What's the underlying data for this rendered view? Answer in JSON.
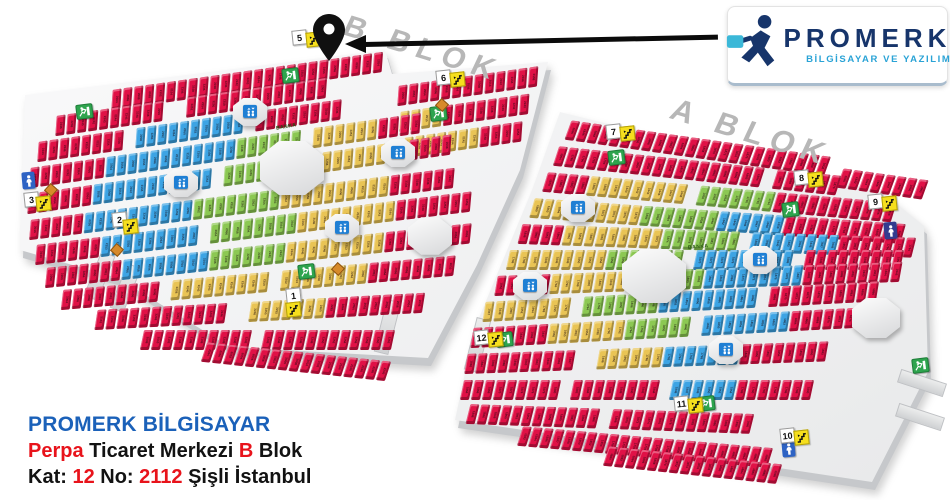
{
  "logo_card": {
    "brand": "PROMERK",
    "tagline": "BİLGİSAYAR VE YAZILIM",
    "brand_color": "#17356b",
    "tagline_color": "#2aa3d6",
    "briefcase_color": "#3bb8d8"
  },
  "address": {
    "line1": "PROMERK BİLGİSAYAR",
    "line2_parts": [
      {
        "t": "Perpa",
        "red": true
      },
      {
        "t": " Ticaret Merkezi ",
        "red": false
      },
      {
        "t": "B",
        "red": true
      },
      {
        "t": " Blok",
        "red": false
      }
    ],
    "line3_parts": [
      {
        "t": "Kat: ",
        "red": false
      },
      {
        "t": "12",
        "red": true
      },
      {
        "t": " No: ",
        "red": false
      },
      {
        "t": "2112",
        "red": true
      },
      {
        "t": " Şişli İstanbul",
        "red": false
      }
    ],
    "accent_blue": "#1b61b9",
    "accent_red": "#e8131b"
  },
  "map": {
    "colors": {
      "red": "#e01146",
      "blue": "#3da4e4",
      "green": "#8cc853",
      "yellow": "#e9c455"
    },
    "block_labels": [
      {
        "text": "B BLOK",
        "x": 352,
        "y": 10,
        "angle": 17,
        "size": 30
      },
      {
        "text": "A BLOK",
        "x": 680,
        "y": 92,
        "angle": 17,
        "size": 31
      }
    ],
    "banka_labels": [
      {
        "text": "BANKA",
        "x": 276,
        "y": 124,
        "angle": -10
      },
      {
        "text": "BANKA",
        "x": 688,
        "y": 244,
        "angle": -5
      }
    ],
    "plates": [
      {
        "id": "b",
        "points": [
          [
            25,
            95
          ],
          [
            385,
            50
          ],
          [
            392,
            74
          ],
          [
            548,
            62
          ],
          [
            520,
            170
          ],
          [
            477,
            265
          ],
          [
            428,
            358
          ],
          [
            230,
            347
          ],
          [
            118,
            278
          ],
          [
            20,
            250
          ]
        ]
      },
      {
        "id": "a",
        "points": [
          [
            560,
            112
          ],
          [
            882,
            192
          ],
          [
            924,
            226
          ],
          [
            928,
            372
          ],
          [
            872,
            482
          ],
          [
            640,
            447
          ],
          [
            455,
            420
          ],
          [
            474,
            330
          ],
          [
            532,
            190
          ]
        ]
      }
    ],
    "rows": [
      {
        "set": "b",
        "x": 112,
        "y": 90,
        "a": -8,
        "segs": [
          [
            "red",
            25
          ]
        ]
      },
      {
        "set": "b",
        "x": 398,
        "y": 86,
        "a": -8,
        "segs": [
          [
            "red",
            13
          ]
        ]
      },
      {
        "set": "b",
        "x": 56,
        "y": 116,
        "a": -8,
        "segs": [
          [
            "red",
            10
          ],
          [
            "gap",
            2
          ],
          [
            "red",
            13
          ]
        ]
      },
      {
        "set": "b",
        "x": 400,
        "y": 112,
        "a": -8,
        "segs": [
          [
            "yellow",
            4
          ],
          [
            "red",
            8
          ]
        ]
      },
      {
        "set": "b",
        "x": 38,
        "y": 142,
        "a": -8,
        "segs": [
          [
            "red",
            8
          ],
          [
            "gap",
            1
          ],
          [
            "blue",
            10
          ],
          [
            "gap",
            1
          ],
          [
            "red",
            8
          ]
        ]
      },
      {
        "set": "b",
        "x": 404,
        "y": 138,
        "a": -8,
        "segs": [
          [
            "yellow",
            7
          ],
          [
            "red",
            4
          ]
        ]
      },
      {
        "set": "b",
        "x": 30,
        "y": 168,
        "a": -8,
        "segs": [
          [
            "red",
            7
          ],
          [
            "blue",
            12
          ],
          [
            "green",
            6
          ],
          [
            "gap",
            1
          ],
          [
            "yellow",
            6
          ],
          [
            "red",
            4
          ]
        ]
      },
      {
        "set": "b",
        "x": 28,
        "y": 194,
        "a": -8,
        "segs": [
          [
            "red",
            6
          ],
          [
            "blue",
            11
          ],
          [
            "gap",
            1
          ],
          [
            "green",
            7
          ],
          [
            "yellow",
            9
          ],
          [
            "red",
            5
          ]
        ]
      },
      {
        "set": "b",
        "x": 30,
        "y": 220,
        "a": -7,
        "segs": [
          [
            "red",
            5
          ],
          [
            "blue",
            10
          ],
          [
            "green",
            8
          ],
          [
            "yellow",
            10
          ],
          [
            "red",
            6
          ]
        ]
      },
      {
        "set": "b",
        "x": 36,
        "y": 245,
        "a": -7,
        "segs": [
          [
            "red",
            6
          ],
          [
            "blue",
            9
          ],
          [
            "gap",
            1
          ],
          [
            "green",
            8
          ],
          [
            "yellow",
            9
          ],
          [
            "red",
            7
          ]
        ]
      },
      {
        "set": "b",
        "x": 46,
        "y": 268,
        "a": -6,
        "segs": [
          [
            "red",
            7
          ],
          [
            "blue",
            8
          ],
          [
            "green",
            7
          ],
          [
            "yellow",
            9
          ],
          [
            "red",
            8
          ]
        ]
      },
      {
        "set": "b",
        "x": 62,
        "y": 290,
        "a": -5,
        "segs": [
          [
            "red",
            9
          ],
          [
            "gap",
            1
          ],
          [
            "yellow",
            9
          ],
          [
            "gap",
            1
          ],
          [
            "yellow",
            8
          ],
          [
            "red",
            8
          ]
        ]
      },
      {
        "set": "b",
        "x": 96,
        "y": 310,
        "a": -3,
        "segs": [
          [
            "red",
            12
          ],
          [
            "gap",
            2
          ],
          [
            "yellow",
            7
          ],
          [
            "red",
            9
          ]
        ]
      },
      {
        "set": "b",
        "x": 142,
        "y": 330,
        "a": 0,
        "segs": [
          [
            "red",
            10
          ],
          [
            "gap",
            1
          ],
          [
            "red",
            12
          ]
        ]
      },
      {
        "set": "b",
        "x": 204,
        "y": 342,
        "a": 6,
        "segs": [
          [
            "red",
            17
          ]
        ]
      },
      {
        "set": "a",
        "x": 568,
        "y": 120,
        "a": 8,
        "segs": [
          [
            "red",
            24
          ]
        ]
      },
      {
        "set": "a",
        "x": 840,
        "y": 168,
        "a": 8,
        "segs": [
          [
            "red",
            8
          ]
        ]
      },
      {
        "set": "a",
        "x": 556,
        "y": 146,
        "a": 6,
        "segs": [
          [
            "red",
            19
          ],
          [
            "gap",
            1
          ],
          [
            "red",
            6
          ]
        ]
      },
      {
        "set": "a",
        "x": 545,
        "y": 172,
        "a": 5,
        "segs": [
          [
            "red",
            4
          ],
          [
            "yellow",
            9
          ],
          [
            "gap",
            1
          ],
          [
            "green",
            7
          ],
          [
            "red",
            11
          ]
        ]
      },
      {
        "set": "a",
        "x": 532,
        "y": 198,
        "a": 4,
        "segs": [
          [
            "yellow",
            10
          ],
          [
            "green",
            7
          ],
          [
            "blue",
            6
          ],
          [
            "red",
            11
          ]
        ]
      },
      {
        "set": "a",
        "x": 520,
        "y": 224,
        "a": 2,
        "segs": [
          [
            "red",
            4
          ],
          [
            "yellow",
            9
          ],
          [
            "green",
            7
          ],
          [
            "gap",
            1
          ],
          [
            "blue",
            8
          ],
          [
            "red",
            7
          ]
        ]
      },
      {
        "set": "a",
        "x": 508,
        "y": 250,
        "a": 0,
        "segs": [
          [
            "yellow",
            9
          ],
          [
            "green",
            7
          ],
          [
            "gap",
            1
          ],
          [
            "blue",
            9
          ],
          [
            "gap",
            1
          ],
          [
            "red",
            9
          ]
        ]
      },
      {
        "set": "a",
        "x": 496,
        "y": 276,
        "a": -2,
        "segs": [
          [
            "red",
            5
          ],
          [
            "yellow",
            8
          ],
          [
            "green",
            6
          ],
          [
            "blue",
            9
          ],
          [
            "red",
            9
          ]
        ]
      },
      {
        "set": "a",
        "x": 484,
        "y": 302,
        "a": -3,
        "segs": [
          [
            "yellow",
            8
          ],
          [
            "gap",
            1
          ],
          [
            "green",
            7
          ],
          [
            "blue",
            9
          ],
          [
            "gap",
            1
          ],
          [
            "red",
            10
          ]
        ]
      },
      {
        "set": "a",
        "x": 472,
        "y": 328,
        "a": -3,
        "segs": [
          [
            "red",
            7
          ],
          [
            "yellow",
            7
          ],
          [
            "green",
            6
          ],
          [
            "gap",
            1
          ],
          [
            "blue",
            8
          ],
          [
            "red",
            9
          ]
        ]
      },
      {
        "set": "a",
        "x": 466,
        "y": 354,
        "a": -2,
        "segs": [
          [
            "red",
            10
          ],
          [
            "gap",
            2
          ],
          [
            "yellow",
            6
          ],
          [
            "blue",
            7
          ],
          [
            "red",
            8
          ]
        ]
      },
      {
        "set": "a",
        "x": 462,
        "y": 380,
        "a": 0,
        "segs": [
          [
            "red",
            9
          ],
          [
            "gap",
            1
          ],
          [
            "red",
            8
          ],
          [
            "gap",
            1
          ],
          [
            "blue",
            6
          ],
          [
            "red",
            7
          ]
        ]
      },
      {
        "set": "a",
        "x": 468,
        "y": 404,
        "a": 2,
        "segs": [
          [
            "red",
            12
          ],
          [
            "gap",
            1
          ],
          [
            "red",
            13
          ]
        ]
      },
      {
        "set": "a",
        "x": 520,
        "y": 426,
        "a": 5,
        "segs": [
          [
            "red",
            23
          ]
        ]
      },
      {
        "set": "a",
        "x": 606,
        "y": 446,
        "a": 6,
        "segs": [
          [
            "red",
            16
          ]
        ]
      }
    ],
    "unit_numbers": {
      "b": [
        "2004",
        "2006",
        "2008",
        "2010",
        "2102",
        "2104",
        "2106",
        "2108",
        "2236",
        "2238",
        "2240",
        "2242",
        "2243",
        "2244",
        "2245",
        "2246",
        "2248",
        "2250",
        "2252",
        "2254",
        "2256",
        "2258",
        "2260",
        "2262",
        "2264",
        "2050",
        "2052",
        "2054",
        "2056",
        "2058"
      ],
      "a": [
        "1836",
        "1846",
        "1848",
        "1850",
        "1852",
        "1854",
        "1856",
        "1858",
        "1860",
        "1862",
        "1864",
        "1866",
        "1868",
        "1870",
        "1872",
        "1874",
        "1876",
        "1878",
        "1880",
        "1882",
        "1884",
        "1886",
        "1888",
        "1938",
        "1940",
        "1942",
        "1944",
        "1946",
        "1947",
        "1948",
        "1950",
        "1952",
        "1954",
        "1788",
        "1790",
        "1792",
        "1794",
        "1796",
        "1798",
        "1800"
      ]
    },
    "octagons": [
      {
        "x": 292,
        "y": 168,
        "r": 32
      },
      {
        "x": 430,
        "y": 236,
        "r": 22
      },
      {
        "x": 654,
        "y": 276,
        "r": 32
      },
      {
        "x": 876,
        "y": 318,
        "r": 24
      }
    ],
    "lifts": [
      {
        "x": 250,
        "y": 112
      },
      {
        "x": 181,
        "y": 183
      },
      {
        "x": 398,
        "y": 153
      },
      {
        "x": 342,
        "y": 228
      },
      {
        "x": 578,
        "y": 208
      },
      {
        "x": 530,
        "y": 286
      },
      {
        "x": 760,
        "y": 260
      },
      {
        "x": 726,
        "y": 350
      }
    ],
    "markers": [
      {
        "n": "1",
        "x": 286,
        "y": 288,
        "sx": 0,
        "sy": 14
      },
      {
        "n": "2",
        "x": 112,
        "y": 212,
        "sx": 11,
        "sy": 7
      },
      {
        "n": "3",
        "x": 24,
        "y": 192,
        "sx": 12,
        "sy": 4
      },
      {
        "n": "5",
        "x": 292,
        "y": 30,
        "sx": 14,
        "sy": 2
      },
      {
        "n": "6",
        "x": 436,
        "y": 70,
        "sx": 14,
        "sy": 2
      },
      {
        "n": "7",
        "x": 606,
        "y": 124,
        "sx": 14,
        "sy": 2
      },
      {
        "n": "8",
        "x": 794,
        "y": 170,
        "sx": 14,
        "sy": 2
      },
      {
        "n": "9",
        "x": 868,
        "y": 194,
        "sx": 14,
        "sy": 2
      },
      {
        "n": "10",
        "x": 780,
        "y": 428,
        "sx": 14,
        "sy": 2
      },
      {
        "n": "11",
        "x": 674,
        "y": 396,
        "sx": 14,
        "sy": 2
      },
      {
        "n": "12",
        "x": 474,
        "y": 330,
        "sx": 14,
        "sy": 2
      }
    ],
    "exits": [
      {
        "x": 76,
        "y": 104
      },
      {
        "x": 282,
        "y": 68
      },
      {
        "x": 430,
        "y": 106
      },
      {
        "x": 298,
        "y": 264
      },
      {
        "x": 608,
        "y": 150
      },
      {
        "x": 782,
        "y": 202
      },
      {
        "x": 496,
        "y": 332
      },
      {
        "x": 698,
        "y": 396
      },
      {
        "x": 912,
        "y": 358
      }
    ],
    "wcs": [
      {
        "x": 22,
        "y": 172,
        "color": "#2e63c4"
      },
      {
        "x": 884,
        "y": 222,
        "color": "#323c8f"
      },
      {
        "x": 782,
        "y": 440,
        "color": "#2e63c4"
      }
    ],
    "diamonds": [
      {
        "x": 46,
        "y": 185
      },
      {
        "x": 112,
        "y": 245
      },
      {
        "x": 333,
        "y": 264
      },
      {
        "x": 437,
        "y": 100
      }
    ],
    "stubs": [
      {
        "x": 92,
        "y": 252,
        "w": 13,
        "h": 46,
        "a": 22
      },
      {
        "x": 118,
        "y": 264,
        "w": 13,
        "h": 46,
        "a": 22
      },
      {
        "x": 380,
        "y": 300,
        "w": 13,
        "h": 52,
        "a": 14
      },
      {
        "x": 470,
        "y": 318,
        "w": 13,
        "h": 52,
        "a": 14
      },
      {
        "x": 898,
        "y": 376,
        "w": 46,
        "h": 12,
        "a": 18
      },
      {
        "x": 896,
        "y": 410,
        "w": 46,
        "h": 12,
        "a": 18
      }
    ]
  }
}
